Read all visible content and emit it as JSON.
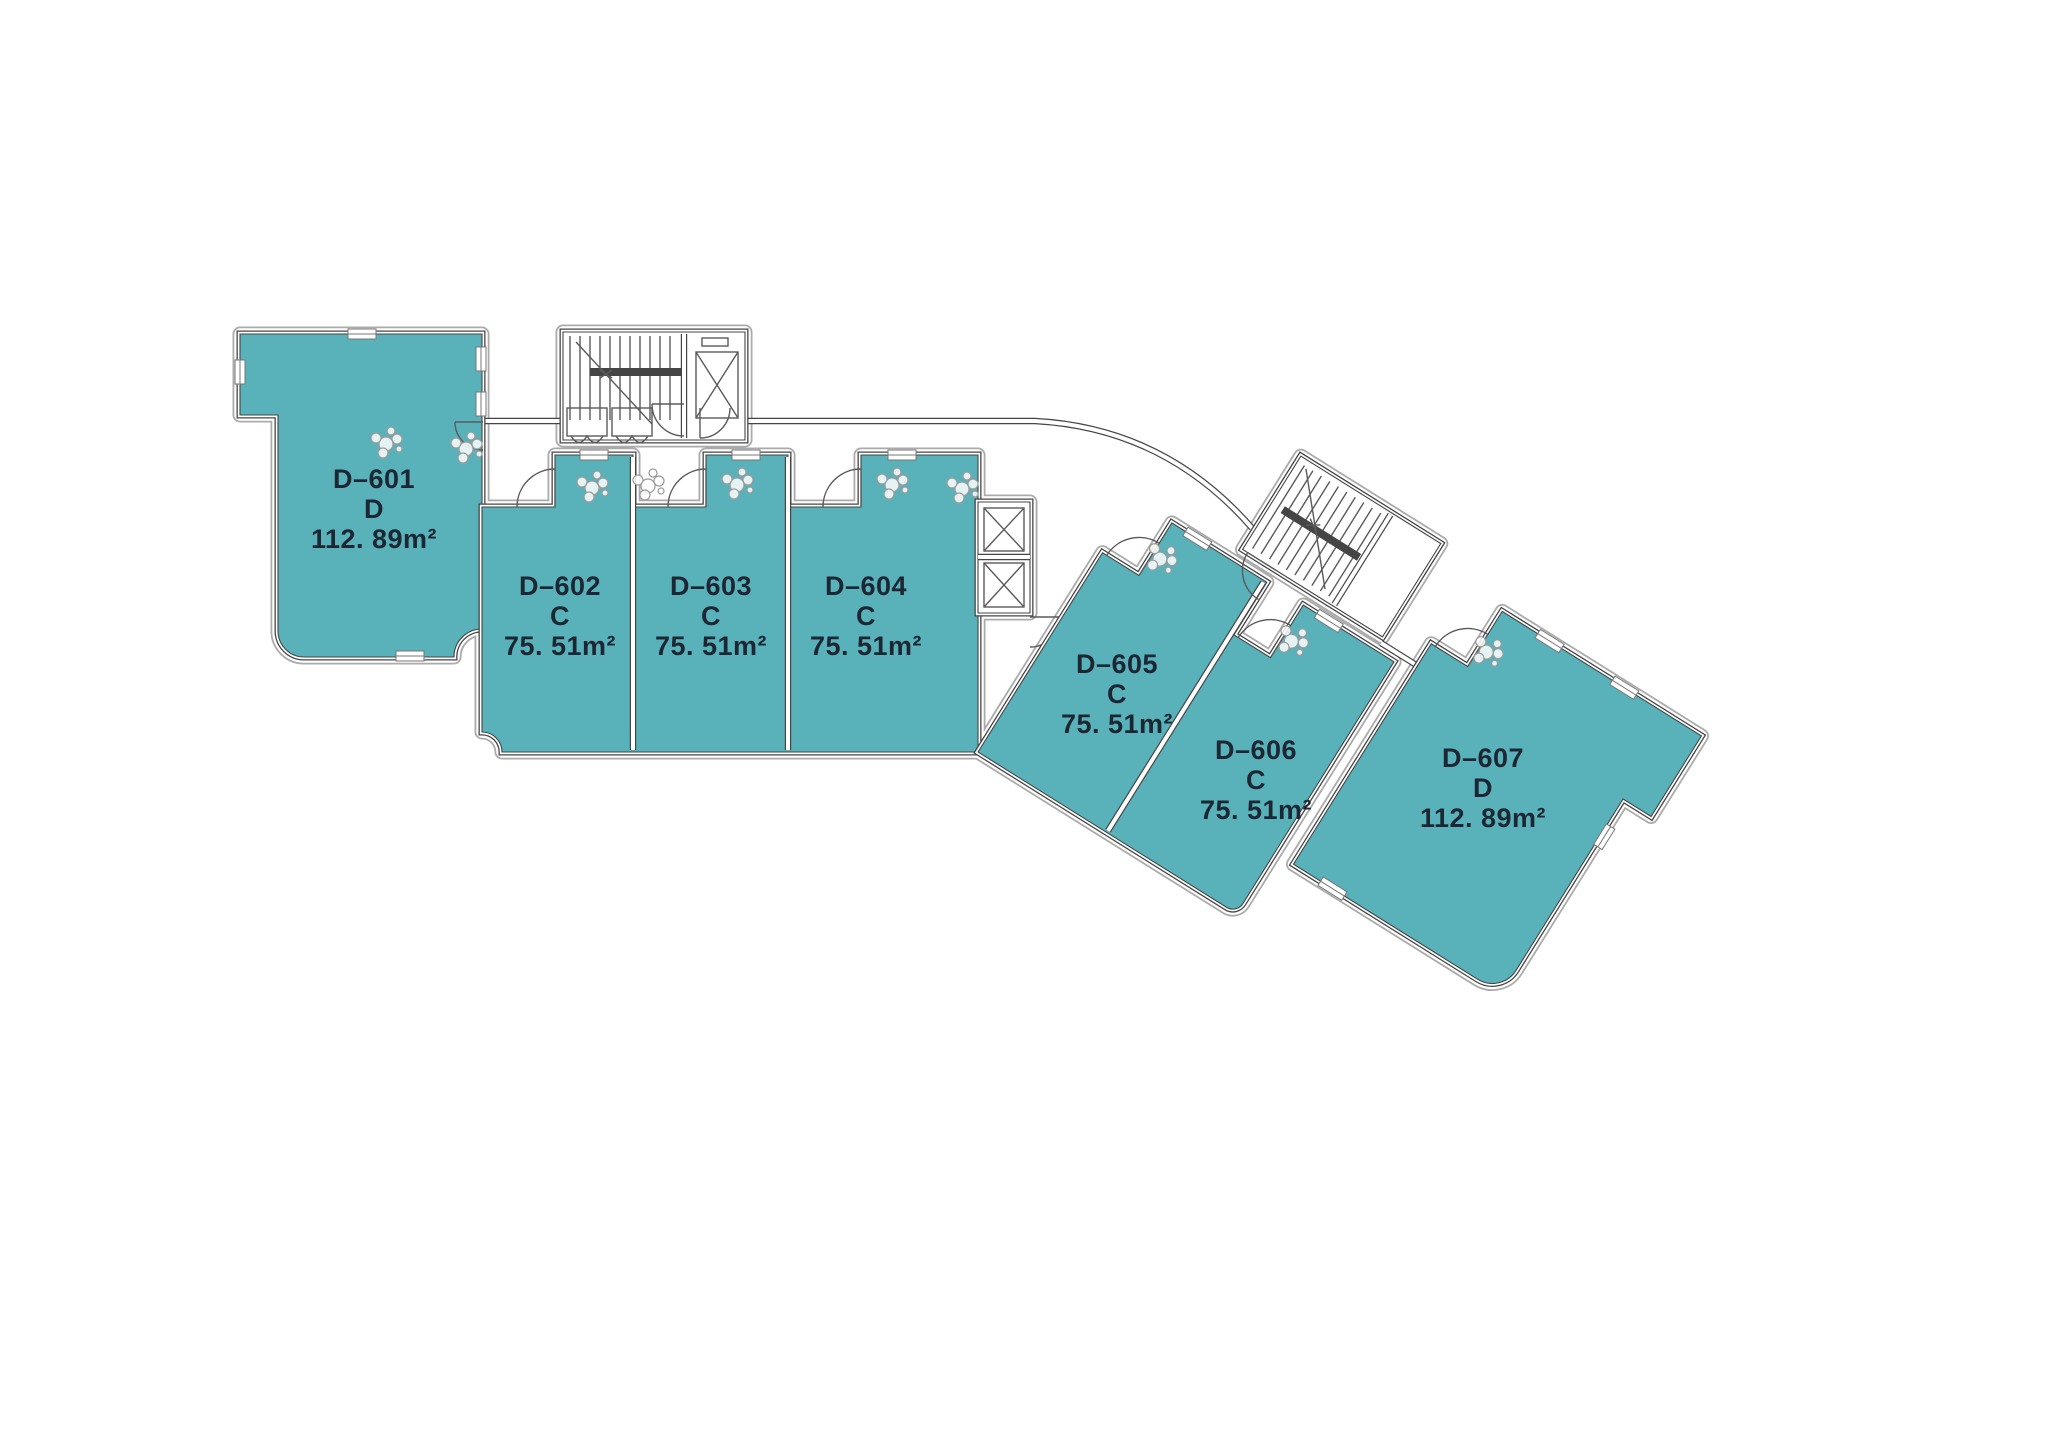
{
  "palette": {
    "background": "#ffffff",
    "unit_fill": "#59b1b9",
    "wall": "#454545",
    "outer_offset_line": "#ababab",
    "detail_line": "#5a5a5a",
    "label_text": "#1c2733"
  },
  "units": [
    {
      "id": "D–601",
      "type": "D",
      "area": "112. 89m²"
    },
    {
      "id": "D–602",
      "type": "C",
      "area": "75. 51m²"
    },
    {
      "id": "D–603",
      "type": "C",
      "area": "75. 51m²"
    },
    {
      "id": "D–604",
      "type": "C",
      "area": "75. 51m²"
    },
    {
      "id": "D–605",
      "type": "C",
      "area": "75. 51m²"
    },
    {
      "id": "D–606",
      "type": "C",
      "area": "75. 51m²"
    },
    {
      "id": "D–607",
      "type": "D",
      "area": "112. 89m²"
    }
  ],
  "symbols": {
    "stairwell": "stairs-icon",
    "elevator": "crossed-box-icon",
    "door": "quarter-arc-icon",
    "plant": "circle-cluster-icon",
    "window": "wall-break-icon"
  }
}
